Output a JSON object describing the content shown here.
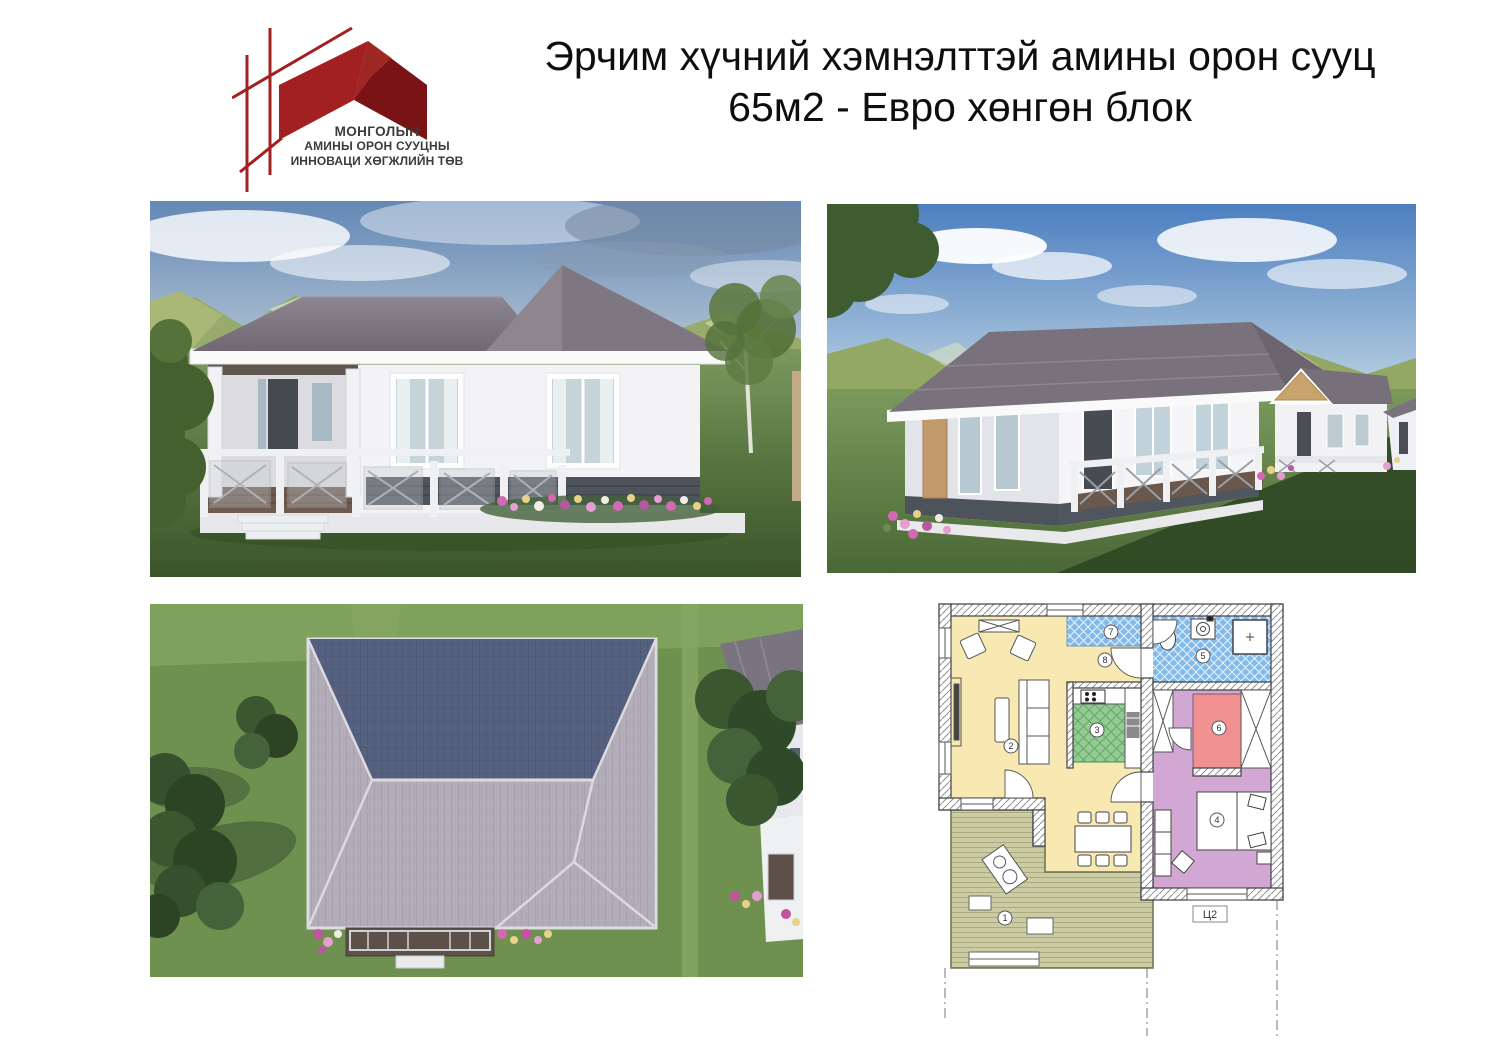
{
  "page": {
    "background": "#ffffff"
  },
  "logo": {
    "org_line1": "МОНГОЛЫН",
    "org_line2": "АМИНЫ ОРОН СУУЦНЫ",
    "org_line3": "ИННОВАЦИ ХӨГЖЛИЙН ТӨВ",
    "brand_red": "#A32022",
    "brand_red_dark": "#7A1315",
    "text_color": "#3B3B3B"
  },
  "title": {
    "line1": "Эрчим хүчний хэмнэлттэй амины орон сууц",
    "line2": "65м2 - Евро хөнгөн блок"
  },
  "floor_plan": {
    "axis_label": "Ц2",
    "tags": [
      {
        "num": "1",
        "room": "terrace"
      },
      {
        "num": "2",
        "room": "living-room"
      },
      {
        "num": "3",
        "room": "kitchen"
      },
      {
        "num": "4",
        "room": "bedroom"
      },
      {
        "num": "5",
        "room": "bathroom"
      },
      {
        "num": "6",
        "room": "wardrobe"
      },
      {
        "num": "7",
        "room": "entry"
      },
      {
        "num": "8",
        "room": "hallway"
      }
    ],
    "colors": {
      "living_room": "#F8E8B2",
      "bathroom": "#83BAEA",
      "kitchen": "#93CB93",
      "wardrobe": "#F19090",
      "bedroom_hall": "#D3A7D3",
      "terrace": "#CBCCA3"
    }
  }
}
